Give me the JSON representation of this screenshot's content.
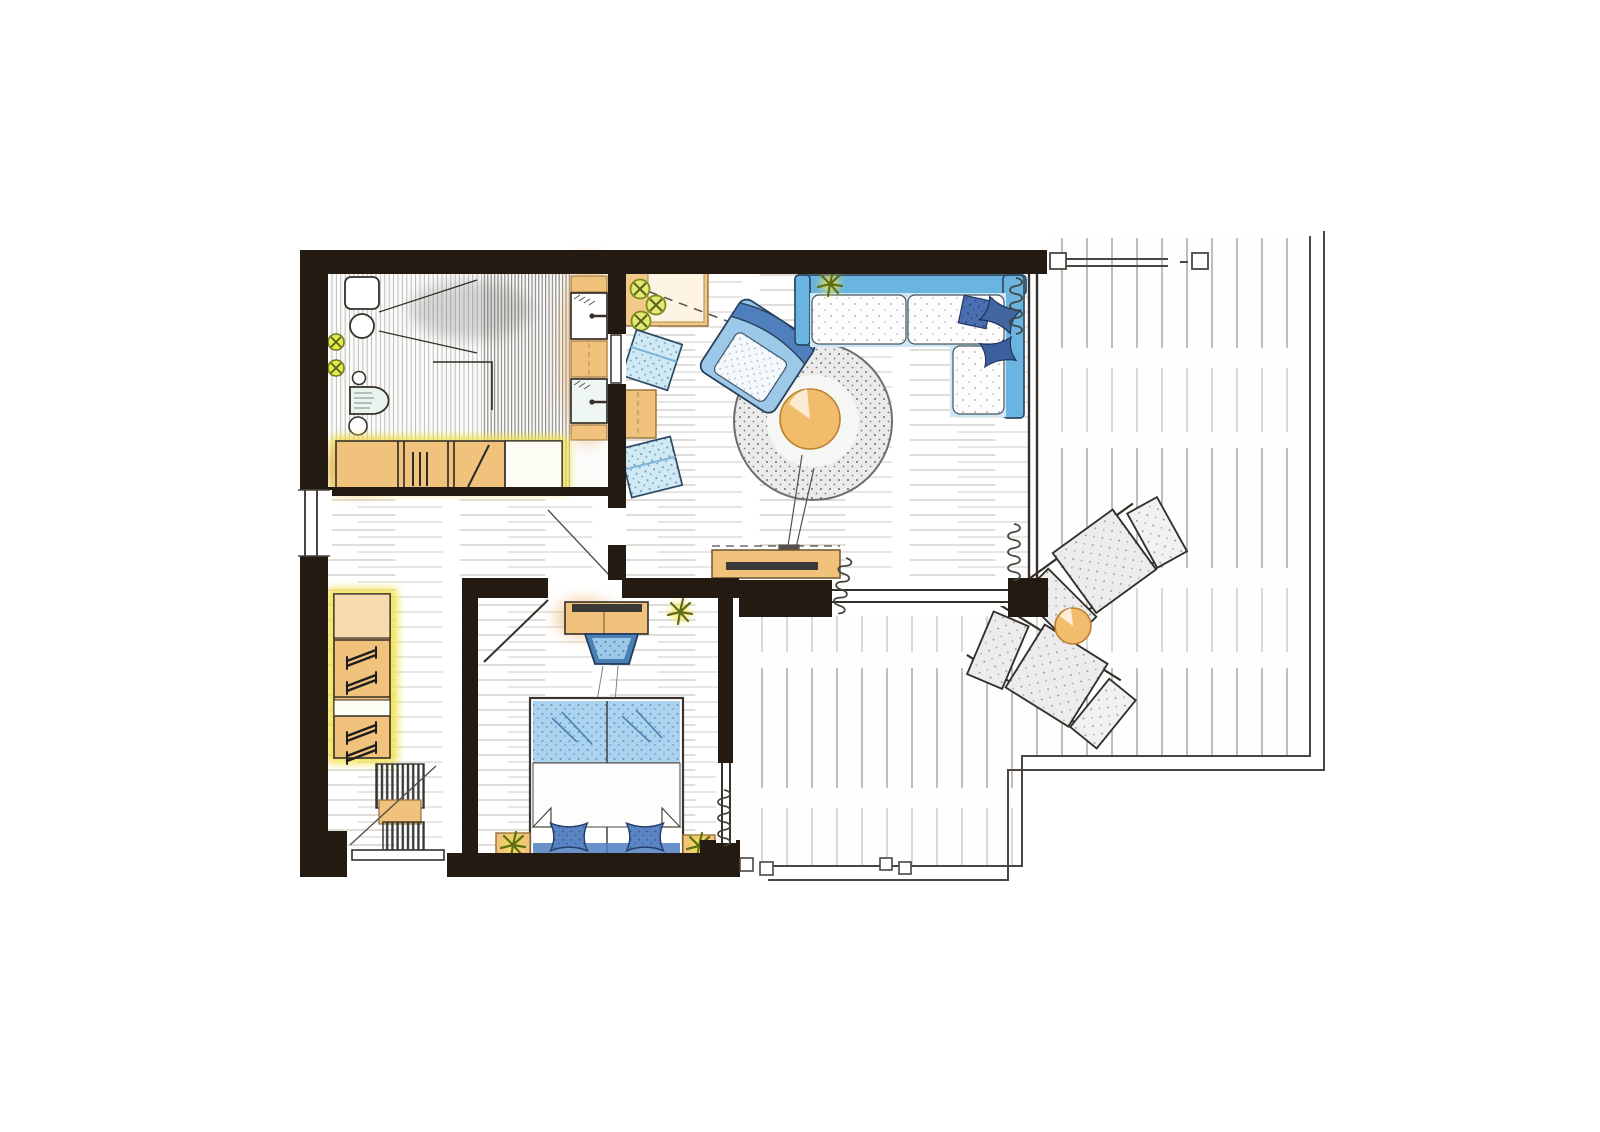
{
  "page": {
    "background": "#ffffff",
    "kind": "hand-drawn apartment floor plan sketch, watercolor style, no text labels"
  },
  "palette": {
    "wall": "#231a12",
    "outline": "#3a352e",
    "wood_line": "#a89e92",
    "deck_line": "#8d8781",
    "railing": "#4a453f",
    "tile_stroke": "#6e6b66",
    "tan": "#f0c27c",
    "tan_light": "#f6dcae",
    "tan_deep": "#e8a95c",
    "highlight_yellow": "#f2e24b",
    "plant_green": "#7d8c1e",
    "plant_fill": "#dde473",
    "sofa_blue": "#69b4e0",
    "wash_blue": "#bfe0f2",
    "pillow_navy": "#4a6fb0",
    "bed_blue": "#a9d3ee",
    "rug_gray": "#ebebeb",
    "cushion_gray": "#ececef",
    "table_orange": "#f2bc6d",
    "glass_cyan": "#d9efe9"
  },
  "floor_plan": {
    "rooms": [
      {
        "id": "bathroom",
        "furniture": [
          "washbasin",
          "toilet",
          "bidet",
          "vanity-basin-upper",
          "vanity-basin-lower",
          "shower-tile-zone",
          "bath-cabinet",
          "faucet-valve",
          "faucet-valve"
        ]
      },
      {
        "id": "hallway",
        "furniture": [
          "wardrobe",
          "coat-hangers",
          "doormat-slats",
          "entrance-door"
        ]
      },
      {
        "id": "living-room",
        "furniture": [
          "corner-sofa",
          "scatter-pillows",
          "armchair",
          "pouf",
          "pouf",
          "round-rug",
          "round-coffee-table",
          "floor-lamp",
          "corner-sideboard",
          "mid-cabinet",
          "tv-lowboard",
          "potted-plants",
          "curtain"
        ]
      },
      {
        "id": "bedroom",
        "furniture": [
          "double-bed",
          "bed-pillows",
          "duvet-fold-corners",
          "nightstand",
          "nightstand",
          "dresser-with-tv",
          "desk-chair",
          "plant",
          "curtain"
        ]
      },
      {
        "id": "terrace",
        "furniture": [
          "sun-lounger",
          "sun-lounger",
          "round-side-table",
          "wood-decking",
          "railing"
        ]
      }
    ],
    "openings": [
      "entrance-door",
      "bathroom-door",
      "bedroom-door",
      "hallway-living-doorway",
      "terrace-sliding-door",
      "bedroom-terrace-door",
      "left-wall-window",
      "top-railing-window",
      "bottom-terrace-railing"
    ]
  }
}
